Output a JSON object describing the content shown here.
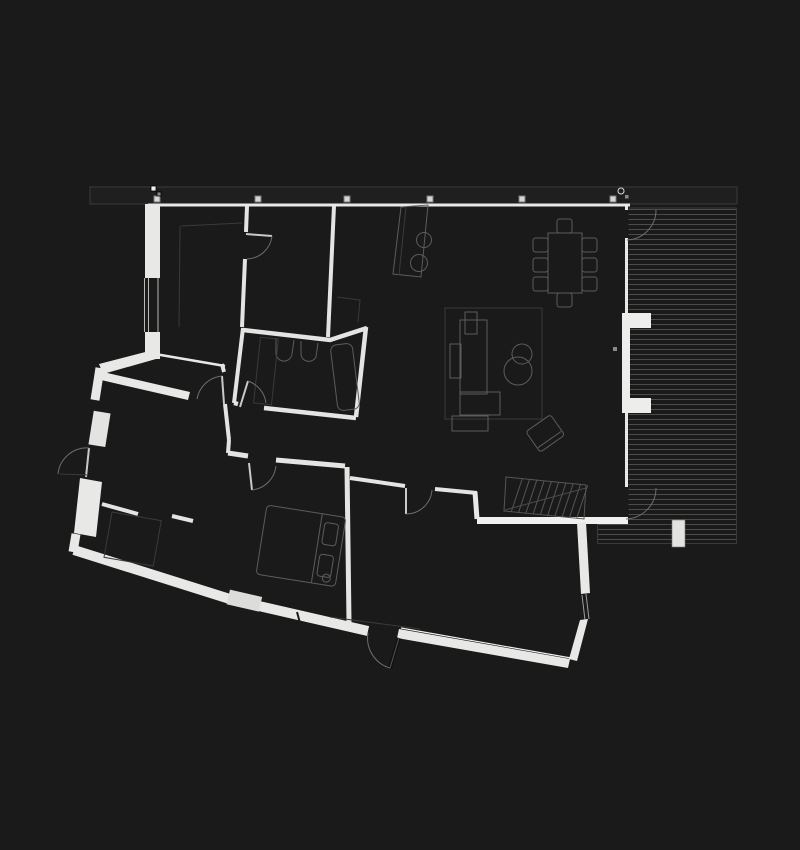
{
  "meta": {
    "description": "dark architectural floor plan, single storey house with angled lower wing and wooden deck",
    "visible_text": [],
    "theme": "dark"
  },
  "colors": {
    "background": "#1a1a1a",
    "roof_band": "#1f1f1f",
    "roof_line": "#3a3a3a",
    "wall": "#e8e8e6",
    "wall_bright": "#f1f1f0",
    "wall_muted": "#d8d8d6",
    "furniture_line": "#5c5c5c",
    "faint_line": "#3a3a3a",
    "deck_line": "#4c4c4c",
    "door_arc": "#6e6e6e",
    "marker_fill": "#d6d6d4",
    "marker_edge": "#7a7a7a"
  },
  "roof": {
    "x1": 90,
    "x2": 737,
    "y1": 187,
    "y2": 204,
    "column_marker_xs": [
      157,
      258,
      347,
      430,
      522,
      613
    ],
    "marker_y": 199,
    "marker_size": 6
  },
  "deck": {
    "main": {
      "x1": 628.5,
      "x2": 736.5,
      "y_start": 209.5,
      "step": 5,
      "count": 63
    },
    "lower": {
      "x1": 597.5,
      "x2": 736.5,
      "y_start": 524.5,
      "step": 5,
      "count": 4
    },
    "border": {
      "right_x": 736.5,
      "bottom_y": 543.5,
      "left_lower_x": 597.5
    },
    "pillar": {
      "x": 672,
      "y": 520,
      "w": 13,
      "h": 27
    }
  },
  "stairs": {
    "x": 506,
    "y": 477,
    "dx": 80,
    "dy": 8,
    "depth": 34,
    "treads": 10,
    "tread_slant": 9
  },
  "dining": {
    "table": {
      "x": 548,
      "y": 233,
      "w": 34,
      "h": 60
    },
    "chair_size": [
      15,
      14
    ],
    "chairs": [
      [
        533,
        238
      ],
      [
        533,
        258
      ],
      [
        533,
        277
      ],
      [
        582,
        238
      ],
      [
        582,
        258
      ],
      [
        582,
        277
      ],
      [
        557,
        219
      ],
      [
        557,
        293
      ]
    ]
  },
  "elements": [
    {
      "name": "roof-overhang",
      "type": "outline"
    },
    {
      "name": "roof-columns",
      "type": "markers",
      "count": 6
    },
    {
      "name": "wood-deck",
      "type": "decking",
      "board_lines": 67
    },
    {
      "name": "outdoor-fireplace",
      "type": "masonry"
    },
    {
      "name": "kitchen-island",
      "type": "furniture",
      "sinks": 2
    },
    {
      "name": "dining-table",
      "type": "furniture",
      "chairs": 8
    },
    {
      "name": "living-rug",
      "type": "furniture"
    },
    {
      "name": "sofa",
      "type": "furniture"
    },
    {
      "name": "coffee-table",
      "type": "furniture",
      "circles": 2
    },
    {
      "name": "lounge-chair",
      "type": "furniture"
    },
    {
      "name": "bathroom",
      "type": "room",
      "fixtures": [
        "basin",
        "basin",
        "bathtub",
        "appliance"
      ]
    },
    {
      "name": "bed",
      "type": "furniture",
      "pillows": 2
    },
    {
      "name": "bedroom-rug",
      "type": "furniture"
    },
    {
      "name": "stairs",
      "type": "circulation",
      "treads": 10
    },
    {
      "name": "door-swings",
      "type": "doors",
      "count": 9
    },
    {
      "name": "entry-door",
      "type": "door"
    },
    {
      "name": "terrace-doors",
      "type": "door",
      "count": 2
    }
  ]
}
